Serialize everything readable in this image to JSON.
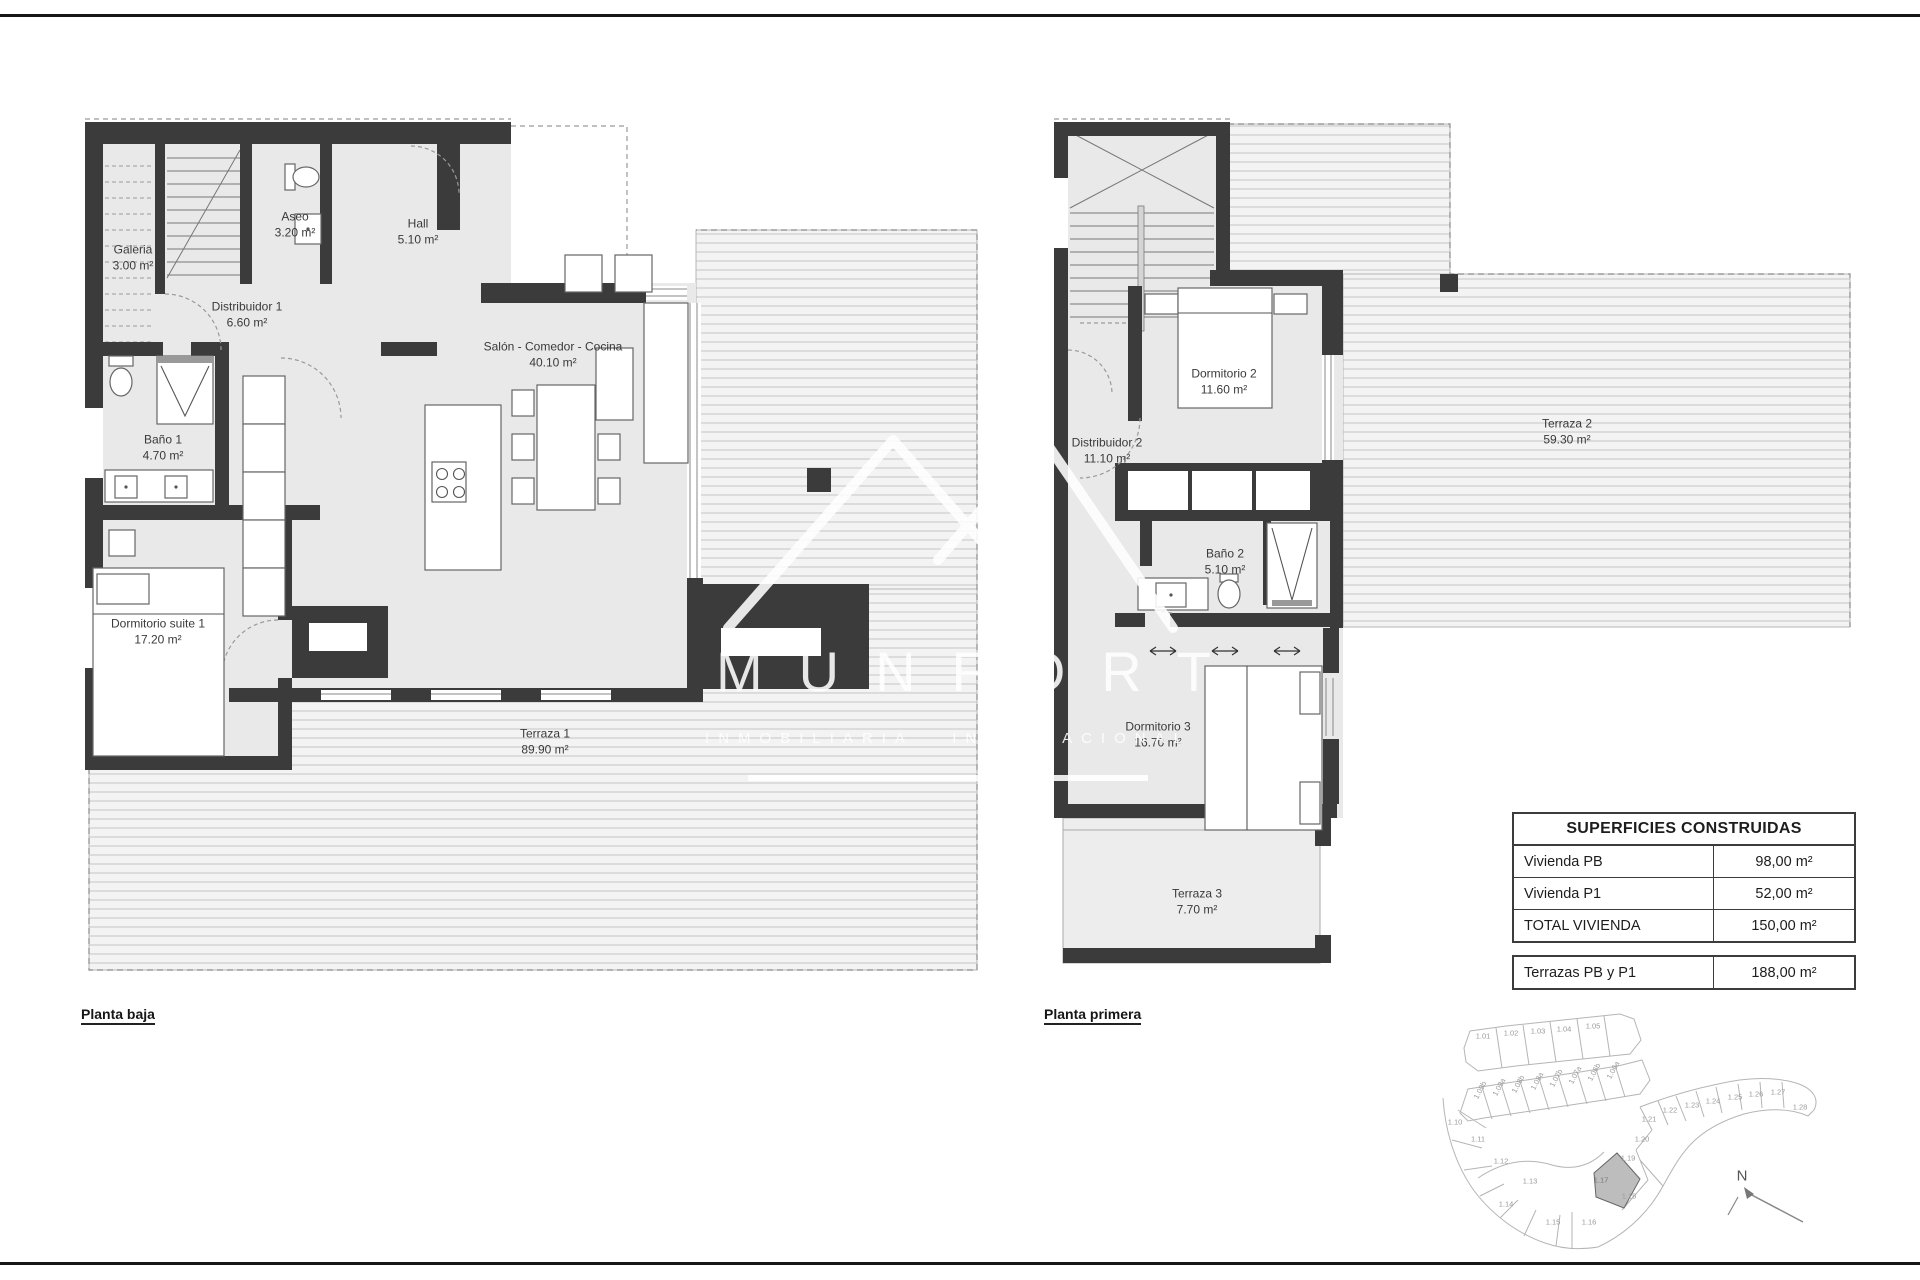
{
  "plans": {
    "planta_baja": {
      "caption": "Planta baja",
      "rooms": [
        {
          "name": "Galeria",
          "area": "3.00 m²"
        },
        {
          "name": "Aseo",
          "area": "3.20 m²"
        },
        {
          "name": "Hall",
          "area": "5.10 m²"
        },
        {
          "name": "Distribuidor 1",
          "area": "6.60 m²"
        },
        {
          "name": "Baño 1",
          "area": "4.70 m²"
        },
        {
          "name": "Salón - Comedor - Cocina",
          "area": "40.10 m²"
        },
        {
          "name": "Dormitorio suite 1",
          "area": "17.20 m²"
        },
        {
          "name": "Terraza 1",
          "area": "89.90 m²"
        }
      ]
    },
    "planta_primera": {
      "caption": "Planta primera",
      "rooms": [
        {
          "name": "Dormitorio 2",
          "area": "11.60 m²"
        },
        {
          "name": "Distribuidor 2",
          "area": "11.10 m²"
        },
        {
          "name": "Baño 2",
          "area": "5.10 m²"
        },
        {
          "name": "Dormitorio 3",
          "area": "16.70 m²"
        },
        {
          "name": "Terraza 2",
          "area": "59.30 m²"
        },
        {
          "name": "Terraza 3",
          "area": "7.70 m²"
        }
      ]
    }
  },
  "watermark": {
    "brand": "MUNFORT",
    "tagline": "INMOBILIARIA INTERNACIONAL"
  },
  "areas_table": {
    "title": "SUPERFICIES CONSTRUIDAS",
    "rows": [
      {
        "label": "Vivienda PB",
        "value": "98,00 m²"
      },
      {
        "label": "Vivienda P1",
        "value": "52,00 m²"
      },
      {
        "label": "TOTAL VIVIENDA",
        "value": "150,00 m²"
      }
    ],
    "footer_row": {
      "label": "Terrazas PB y P1",
      "value": "188,00 m²"
    }
  },
  "site_plan": {
    "highlighted_plot": "1.17",
    "north_label": "N",
    "plots_top": [
      "1.01",
      "1.02",
      "1.03",
      "1.04",
      "1.05"
    ],
    "plots_mid": [
      "1.09b",
      "1.09a",
      "1.08b",
      "1.08a",
      "1.07b",
      "1.07a",
      "1.06b",
      "1.06a"
    ],
    "plots_left": [
      "1.10",
      "1.11",
      "1.12",
      "1.13",
      "1.14",
      "1.15",
      "1.16"
    ],
    "plots_right": [
      "1.18",
      "1.19",
      "1.20",
      "1.21",
      "1.22",
      "1.23",
      "1.24",
      "1.25",
      "1.26",
      "1.27",
      "1.28"
    ]
  }
}
